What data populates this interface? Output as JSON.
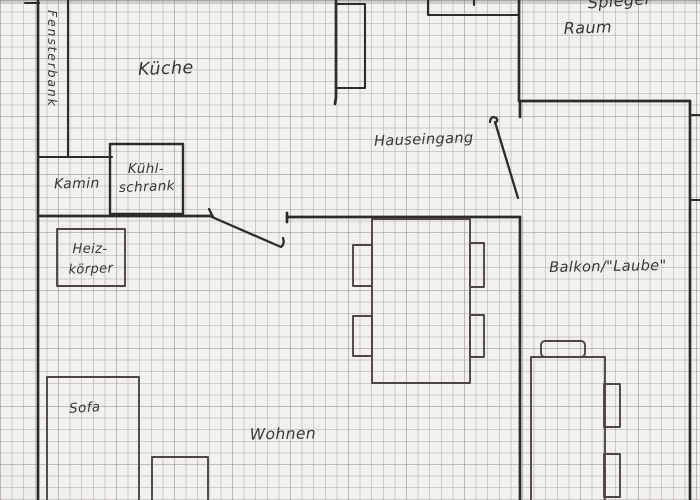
{
  "drawing": {
    "kind": "hand-drawn apartment floor plan on squared graph paper"
  },
  "colors": {
    "paper": "#f3f1ec",
    "grid_line": "#97948f",
    "wall_ink": "#2d2c29",
    "furniture_ink": "#4b4844",
    "text_ink": "#393731"
  },
  "labels": {
    "fensterbank": "Fensterbank",
    "kueche": "Küche",
    "kamin": "Kamin",
    "kuehlschrank_line1": "Kühl-",
    "kuehlschrank_line2": "schrank",
    "hauseingang": "Hauseingang",
    "top_right_room_line1_partial": "Spiegel-",
    "top_right_room_line2": "Raum",
    "heizkoerper_line1": "Heiz-",
    "heizkoerper_line2": "körper",
    "balkon_laube": "Balkon/\"Laube\"",
    "sofa": "Sofa",
    "wohnen": "Wohnen"
  }
}
